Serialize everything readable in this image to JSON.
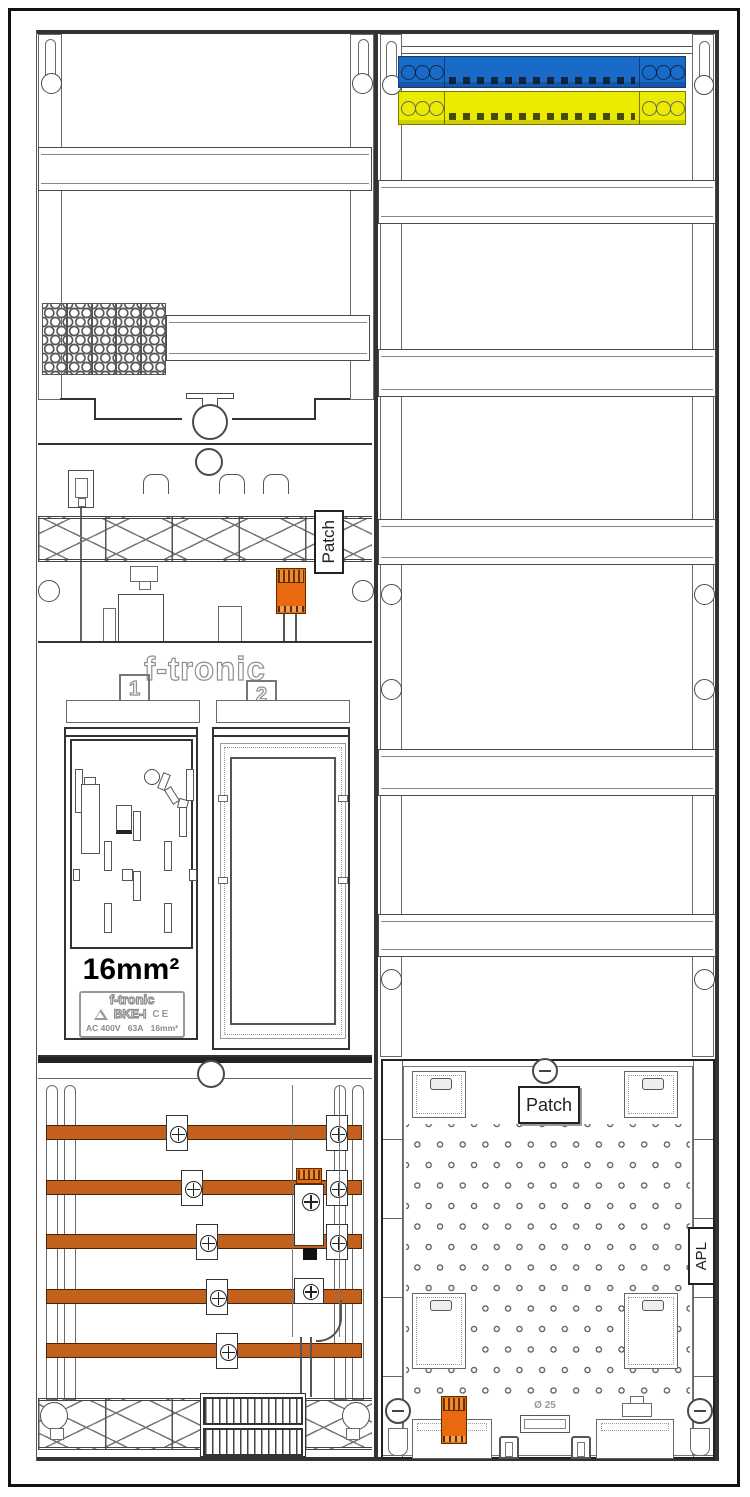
{
  "drawing": {
    "kind": "electrical meter cabinet layout drawing",
    "labels": {
      "brand": "f-tronic",
      "field_1": "1",
      "field_2": "2",
      "cross_section_big": "16mm²",
      "patch_left": "Patch",
      "patch_right": "Patch",
      "apl": "APL",
      "conduit": "Ø 25"
    },
    "nameplate": {
      "brand": "f-tronic",
      "model": "BKE-I",
      "ce_mark": "CE",
      "voltage": "AC 400V",
      "current": "63A",
      "cross_section": "16mm²"
    },
    "colors": {
      "busbar_orange": "#c2611e",
      "neutral_bar_blue": "#1a6bc8",
      "pe_bar_yellow": "#ebeb00",
      "connector_orange": "#e8690f"
    }
  }
}
